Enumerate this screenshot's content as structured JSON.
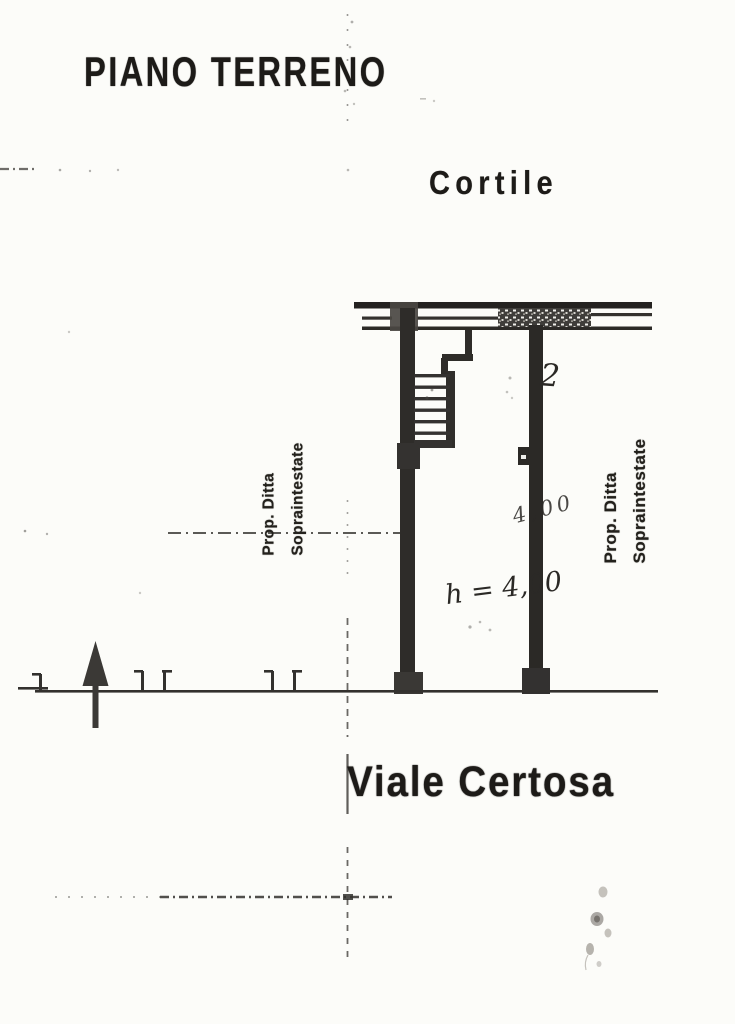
{
  "document": {
    "title": "PIANO TERRENO",
    "courtyard_label": "Cortile",
    "street_label": "Viale Certosa"
  },
  "plan": {
    "property_label_left": {
      "line1": "Prop. Ditta",
      "line2": "Sopraintestate"
    },
    "property_label_right": {
      "line1": "Prop. Ditta",
      "line2": "Sopraintestate"
    },
    "annotations": {
      "room_number": "2",
      "height_note": "h = 4,00",
      "dimension_note": "4,00"
    },
    "icons": {
      "north_arrow": "north-arrow"
    }
  },
  "colors": {
    "paper": "#fcfcf9",
    "ink": "#1d1b18",
    "wall": "#2e2c29"
  }
}
